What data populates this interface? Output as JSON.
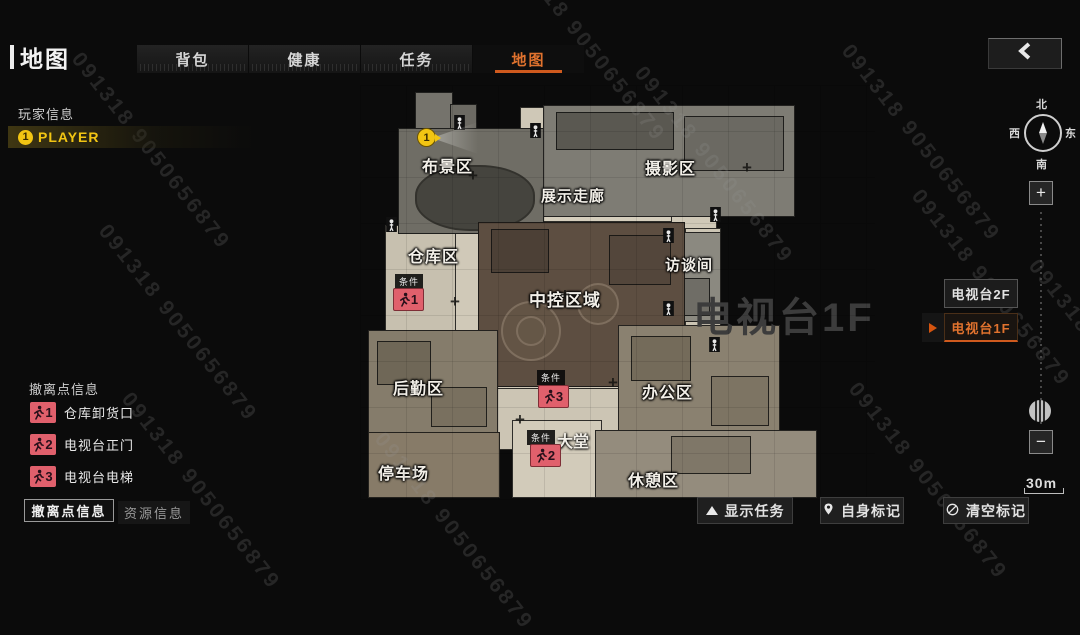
{
  "header": {
    "title": "地图",
    "tabs": [
      {
        "label": "背包",
        "active": false
      },
      {
        "label": "健康",
        "active": false
      },
      {
        "label": "任务",
        "active": false
      },
      {
        "label": "地图",
        "active": true
      }
    ],
    "back_icon": "chevron-left"
  },
  "player_info": {
    "heading": "玩家信息",
    "player": {
      "number": "1",
      "name": "PLAYER"
    }
  },
  "evac_info": {
    "heading": "撤离点信息",
    "items": [
      {
        "number": "1",
        "label": "仓库卸货口"
      },
      {
        "number": "2",
        "label": "电视台正门"
      },
      {
        "number": "3",
        "label": "电视台电梯"
      }
    ]
  },
  "bottom_tabs": [
    {
      "label": "撤离点信息",
      "active": true
    },
    {
      "label": "资源信息",
      "active": false
    }
  ],
  "map": {
    "floor_label": "电视台1F",
    "rooms": [
      {
        "label": "布景区"
      },
      {
        "label": "摄影区"
      },
      {
        "label": "展示走廊"
      },
      {
        "label": "仓库区"
      },
      {
        "label": "访谈间"
      },
      {
        "label": "中控区域"
      },
      {
        "label": "后勤区"
      },
      {
        "label": "办公区"
      },
      {
        "label": "大堂"
      },
      {
        "label": "停车场"
      },
      {
        "label": "休憩区"
      }
    ],
    "markers": [
      {
        "condition": "条件",
        "number": "1"
      },
      {
        "condition": "条件",
        "number": "2"
      },
      {
        "condition": "条件",
        "number": "3"
      }
    ],
    "player_marker": {
      "number": "1"
    }
  },
  "floor_switcher": {
    "options": [
      {
        "label": "电视台2F",
        "active": false
      },
      {
        "label": "电视台1F",
        "active": true
      }
    ]
  },
  "compass": {
    "north": "北",
    "south": "南",
    "east": "东",
    "west": "西"
  },
  "zoom_controls": {
    "plus": "+",
    "minus": "−"
  },
  "scale": {
    "label": "30m"
  },
  "action_buttons": [
    {
      "icon": "up-arrow",
      "label": "显示任务"
    },
    {
      "icon": "location-pin",
      "label": "自身标记"
    },
    {
      "icon": "clear-circle",
      "label": "清空标记"
    }
  ],
  "watermark": {
    "text": "091318 9050656879"
  },
  "colors": {
    "accent_orange": "#e0722e",
    "evac_red": "#e0606c",
    "player_yellow": "#f2c513",
    "map_floor_light": "#d0c9b8",
    "map_room_brown": "#5d4e41"
  }
}
